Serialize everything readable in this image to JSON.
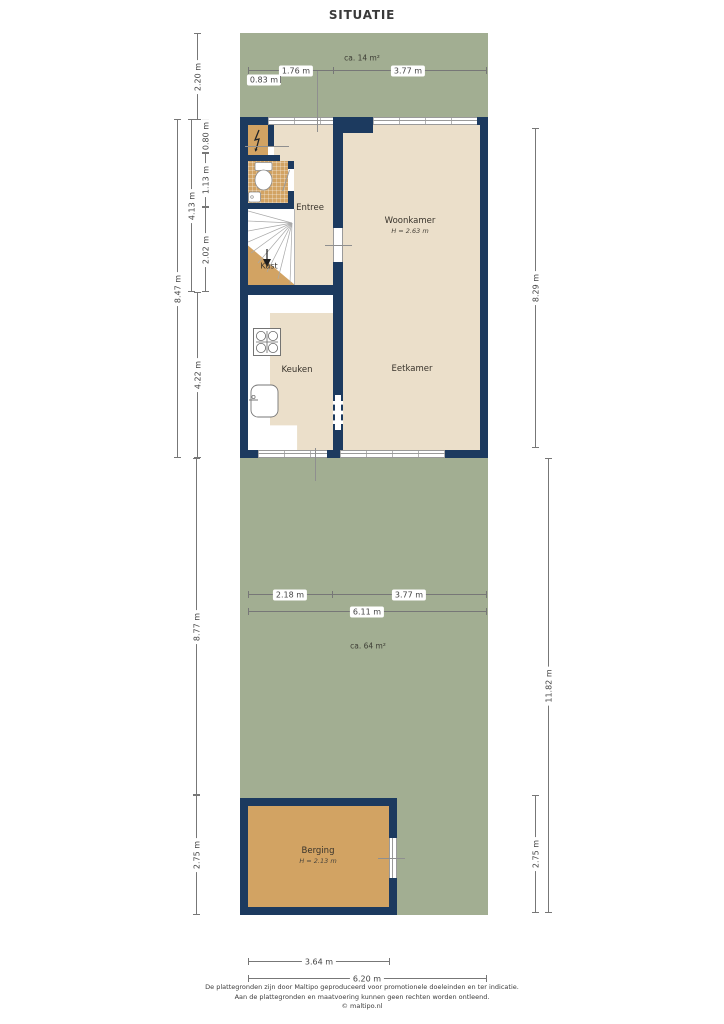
{
  "title": "SITUATIE",
  "plan": {
    "front_yard": {
      "area": "ca. 14 m²"
    },
    "garden": {
      "area": "ca. 64 m²"
    },
    "rooms": {
      "entree": "Entree",
      "woonkamer": "Woonkamer",
      "woonkamer_height": "H = 2.63 m",
      "eetkamer": "Eetkamer",
      "keuken": "Keuken",
      "kast": "Kast",
      "berging": "Berging",
      "berging_height": "H = 2.13 m"
    },
    "icons": {
      "meter_cupboard": "lightning-icon",
      "toilet": "toilet-icon",
      "stairs": "stairs-icon",
      "stove": "stove-icon",
      "sink": "sink-icon"
    }
  },
  "dimensions": {
    "top_left_offset": "0.83 m",
    "top_entree": "1.76 m",
    "top_woonkamer": "3.77 m",
    "left_front_yard": "2.20 m",
    "left_meterkast": "0.80 m",
    "left_toilet": "1.13 m",
    "left_stairs": "2.02 m",
    "left_hall_total": "4.13 m",
    "left_house_total": "8.47 m",
    "left_keuken": "4.22 m",
    "left_garden": "8.77 m",
    "left_berging": "2.75 m",
    "right_house": "8.29 m",
    "right_garden_total": "11.82 m",
    "right_berging": "2.75 m",
    "garden_left": "2.18 m",
    "garden_right": "3.77 m",
    "garden_total": "6.11 m",
    "bottom_berging": "3.64 m",
    "bottom_total": "6.20 m"
  },
  "footer": {
    "line1": "De plattegronden zijn door Maltipo geproduceerd voor promotionele doeleinden en ter indicatie.",
    "line2": "Aan de plattegronden en maatvoering kunnen geen rechten worden ontleend.",
    "line3": "© maltipo.nl"
  },
  "colors": {
    "wall": "#1c3a5f",
    "plot_green": "#a2ae92",
    "floor_beige": "#ebdfca",
    "floor_tan": "#d2a363",
    "dim_line": "#777777",
    "text": "#3a3a3a"
  }
}
